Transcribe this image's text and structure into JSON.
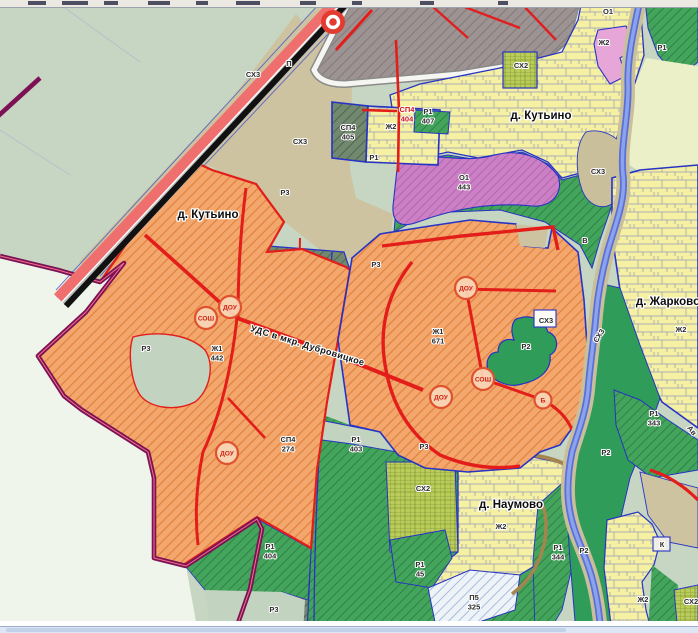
{
  "map": {
    "settlements": [
      {
        "name": "д. Кутьино",
        "x": 208,
        "y": 218
      },
      {
        "name": "д. Кутьино",
        "x": 541,
        "y": 119
      },
      {
        "name": "д. Наумово",
        "x": 511,
        "y": 508
      },
      {
        "name": "д. Жарково",
        "x": 668,
        "y": 305
      }
    ],
    "zone_labels": [
      {
        "t": "СХ3",
        "x": 253,
        "y": 77
      },
      {
        "t": "П",
        "x": 289,
        "y": 66
      },
      {
        "t": "СХ3",
        "x": 300,
        "y": 144
      },
      {
        "t": "СХ2",
        "x": 521,
        "y": 68
      },
      {
        "t": "О1",
        "x": 608,
        "y": 14
      },
      {
        "t": "Ж2",
        "x": 604,
        "y": 45
      },
      {
        "t": "Р1",
        "x": 662,
        "y": 50
      },
      {
        "t": "СП4",
        "n": "405",
        "x": 348,
        "y": 130
      },
      {
        "t": "Ж2",
        "x": 391,
        "y": 129
      },
      {
        "t": "СП4",
        "n": "404",
        "x": 407,
        "y": 112,
        "c": "#cc1616"
      },
      {
        "t": "Р1",
        "n": "407",
        "x": 428,
        "y": 114
      },
      {
        "t": "Р1",
        "x": 374,
        "y": 160
      },
      {
        "t": "О1",
        "n": "443",
        "x": 464,
        "y": 180
      },
      {
        "t": "СХ3",
        "x": 598,
        "y": 174
      },
      {
        "t": "Р3",
        "x": 285,
        "y": 195
      },
      {
        "t": "Р3",
        "x": 376,
        "y": 267
      },
      {
        "t": "В",
        "x": 585,
        "y": 243
      },
      {
        "t": "Ж1",
        "n": "442",
        "x": 217,
        "y": 351
      },
      {
        "t": "Ж1",
        "n": "671",
        "x": 438,
        "y": 334
      },
      {
        "t": "Р3",
        "x": 146,
        "y": 351
      },
      {
        "t": "СХ3",
        "x": 546,
        "y": 323
      },
      {
        "t": "СХ3",
        "x": 601,
        "y": 337,
        "r": -58
      },
      {
        "t": "Р2",
        "x": 526,
        "y": 349
      },
      {
        "t": "Ж2",
        "x": 681,
        "y": 332
      },
      {
        "t": "СП4",
        "n": "274",
        "x": 288,
        "y": 442
      },
      {
        "t": "Р1",
        "n": "403",
        "x": 356,
        "y": 442
      },
      {
        "t": "Р3",
        "x": 424,
        "y": 449
      },
      {
        "t": "Р1",
        "n": "404",
        "x": 270,
        "y": 549
      },
      {
        "t": "Р1",
        "n": "343",
        "x": 654,
        "y": 416
      },
      {
        "t": "СХ2",
        "x": 423,
        "y": 491
      },
      {
        "t": "Ж2",
        "x": 501,
        "y": 529
      },
      {
        "t": "Р1",
        "n": "45",
        "x": 420,
        "y": 567
      },
      {
        "t": "Р2",
        "x": 606,
        "y": 455
      },
      {
        "t": "Р1",
        "n": "344",
        "x": 558,
        "y": 550
      },
      {
        "t": "Р2",
        "x": 584,
        "y": 553
      },
      {
        "t": "П5",
        "n": "325",
        "x": 474,
        "y": 600
      },
      {
        "t": "Ж2",
        "x": 643,
        "y": 602
      },
      {
        "t": "СХ2",
        "x": 691,
        "y": 604
      },
      {
        "t": "К",
        "x": 662,
        "y": 547
      },
      {
        "t": "Р3",
        "x": 274,
        "y": 612
      },
      {
        "t": "Ав",
        "x": 690,
        "y": 432,
        "r": 52
      }
    ],
    "facility_badges": [
      {
        "label": "ДОУ",
        "x": 230,
        "y": 307
      },
      {
        "label": "СОШ",
        "x": 206,
        "y": 318
      },
      {
        "label": "ДОУ",
        "x": 227,
        "y": 453
      },
      {
        "label": "ДОУ",
        "x": 466,
        "y": 288
      },
      {
        "label": "ДОУ",
        "x": 441,
        "y": 397
      },
      {
        "label": "СОШ",
        "x": 483,
        "y": 379
      },
      {
        "label": "Б",
        "x": 543,
        "y": 400
      }
    ],
    "road_label": {
      "text": "УДС в мкр. Дубровицкое",
      "x": 250,
      "y": 331,
      "rot": 17
    },
    "colors": {
      "residential_individual_zh2": "#f7f1a3",
      "residential_planned_zh1": "#f3a76d",
      "forest_sage_background": "#c6d6c2",
      "special_sp4": "#72886f",
      "recreation_r1_hatch": "#43a45c",
      "recreation_r2_solid": "#2f9c59",
      "public_o1": "#cb80c5",
      "agriculture_ch2": "#b9cd58",
      "agriculture_ch3_tan": "#cdc3a1",
      "industrial_gray": "#9d9393",
      "water_river": "#8ba3ec",
      "road_red": "#e31e1a",
      "boundary_maroon": "#7c1254",
      "boundary_blue": "#2733c4",
      "badge_ring": "#e0512e"
    }
  }
}
